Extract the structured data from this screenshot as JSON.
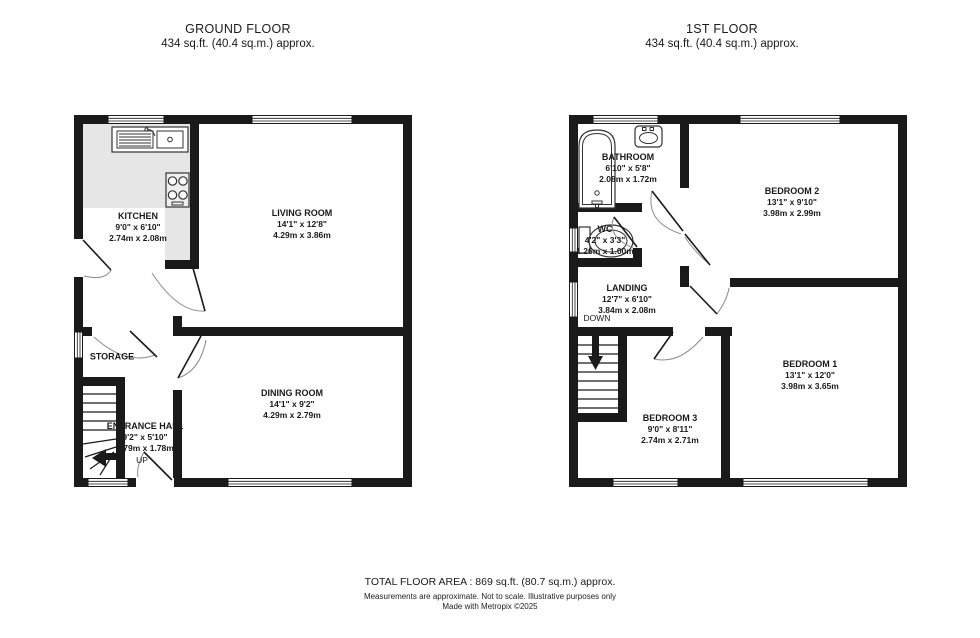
{
  "ground_floor": {
    "title": "GROUND FLOOR",
    "area": "434 sq.ft. (40.4 sq.m.) approx.",
    "rooms": {
      "kitchen": {
        "name": "KITCHEN",
        "imperial": "9'0\" x 6'10\"",
        "metric": "2.74m x 2.08m"
      },
      "living_room": {
        "name": "LIVING ROOM",
        "imperial": "14'1\" x 12'8\"",
        "metric": "4.29m x 3.86m"
      },
      "dining_room": {
        "name": "DINING ROOM",
        "imperial": "14'1\" x 9'2\"",
        "metric": "4.29m x 2.79m"
      },
      "storage": {
        "name": "STORAGE"
      },
      "entrance_hall": {
        "name": "ENTRANCE HALL",
        "imperial": "9'2\" x 5'10\"",
        "metric": "2.79m x 1.78m"
      }
    },
    "stair_label": "UP"
  },
  "first_floor": {
    "title": "1ST FLOOR",
    "area": "434 sq.ft. (40.4 sq.m.) approx.",
    "rooms": {
      "bathroom": {
        "name": "BATHROOM",
        "imperial": "6'10\" x 5'8\"",
        "metric": "2.08m x 1.72m"
      },
      "wc": {
        "name": "WC",
        "imperial": "4'2\" x 3'3\"",
        "metric": "1.26m x 1.00m"
      },
      "bedroom_2": {
        "name": "BEDROOM 2",
        "imperial": "13'1\" x 9'10\"",
        "metric": "3.98m x 2.99m"
      },
      "bedroom_1": {
        "name": "BEDROOM 1",
        "imperial": "13'1\" x 12'0\"",
        "metric": "3.98m x 3.65m"
      },
      "bedroom_3": {
        "name": "BEDROOM 3",
        "imperial": "9'0\" x 8'11\"",
        "metric": "2.74m x 2.71m"
      },
      "landing": {
        "name": "LANDING",
        "imperial": "12'7\" x 6'10\"",
        "metric": "3.84m x 2.08m"
      }
    },
    "stair_label": "DOWN"
  },
  "footer": {
    "total": "TOTAL FLOOR AREA : 869 sq.ft. (80.7 sq.m.) approx.",
    "disclaimer": "Measurements are approximate.  Not to scale.  Illustrative purposes only",
    "credit": "Made with Metropix ©2025"
  },
  "icons": {
    "kitchen_sink": "sink-icon",
    "hob": "hob-icon",
    "bathtub": "bathtub-icon",
    "wash_basin": "wash-basin-icon",
    "toilet": "toilet-icon",
    "stairs_up": "up-arrow-icon",
    "stairs_down": "down-arrow-icon"
  },
  "colors": {
    "wall": "#1a1a1a",
    "counter": "#e6e6e6",
    "background": "#ffffff"
  }
}
